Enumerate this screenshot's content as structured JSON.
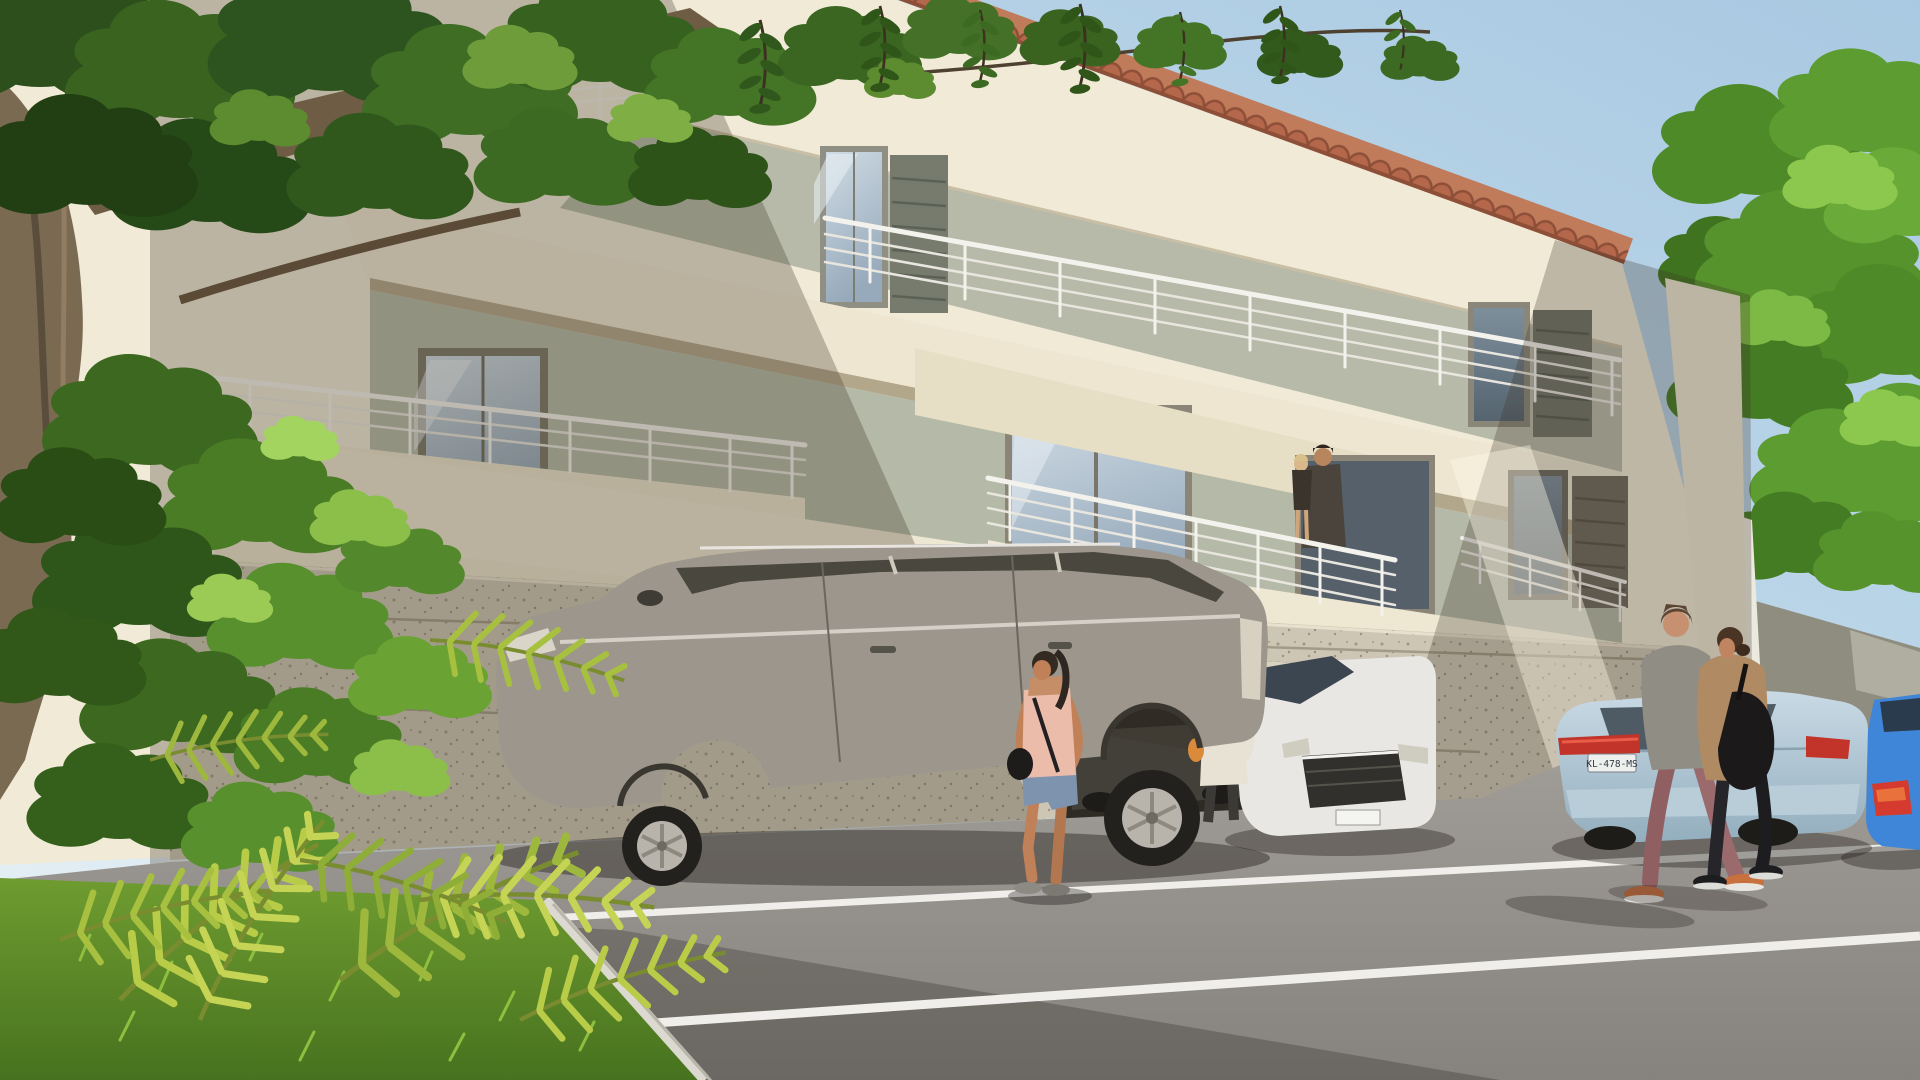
{
  "scene": {
    "type": "architectural-3d-render",
    "description": "Sunny 3D exterior rendering of a new three-storey cream apartment building with white balconies and steel railings, terracotta tile roof edge, textured stone ground floor with an open parking garage, cars parked on an asphalt lot with white bay lines, lush green tree and palm fronds in the left foreground, a second green tree at right behind a garden wall.",
    "license_plate": "KL-478-MS",
    "building": {
      "storeys": 3,
      "balcony_railing_runs": 5,
      "windows_with_shutters": 4,
      "garage_openings": 1
    },
    "vehicles": [
      "gray-station-wagon",
      "white-sedan",
      "light-blue-sedan",
      "dark-car-in-garage",
      "bright-blue-car-at-edge"
    ],
    "people": [
      "woman-pink-tank-top",
      "person-white-shirt-beanie",
      "man-holding-child-on-balcony",
      "walking-man-gray-sweater",
      "walking-woman-tan-cardigan"
    ],
    "vegetation": [
      "large-foreground-tree",
      "bush-column",
      "palm-fronds",
      "grass-strip",
      "right-side-tree"
    ]
  },
  "colors": {
    "sky_top": "#a9c9e2",
    "sky_mid": "#c2daea",
    "sky_horizon": "#e4eef4",
    "wall_cream": "#f1ead7",
    "wall_cream_shade": "#d8cdb4",
    "wall_recess": "#b7baa9",
    "slab_underside": "#b3a78b",
    "roof_tile": "#b4674a",
    "roof_tile_dark": "#8e4f38",
    "ground_wall": "#cdc6b5",
    "garage_dark": "#2e2b25",
    "asphalt": "#a5a19b",
    "asphalt_dark": "#86827e",
    "parking_line": "#efeeea",
    "grass": "#6f9c30",
    "grass_dark": "#47721f",
    "foliage_dark": "#2d4f1c",
    "foliage_mid": "#447426",
    "foliage_bright": "#8cbf4a",
    "palm_bright": "#c6d455",
    "trunk": "#7b6a52",
    "railing": "#f4f2ec",
    "window_glass": "#b6c6d2",
    "shutter_gray": "#767b6e",
    "car_gray": "#9c968c",
    "car_white": "#e8e7e3",
    "car_light_blue": "#b8cfdd",
    "car_bright_blue": "#3f86d8",
    "taillight_red": "#c2342a",
    "plate_bg": "#eef0ee",
    "plate_text_color": "#333a44",
    "skin": "#c08058",
    "tank_top_pink": "#ecbcab",
    "denim": "#7e94ae",
    "sweater_gray": "#8f8d84",
    "pants_mauve": "#9a6a6d",
    "cardigan_tan": "#b08a62",
    "garden_wall": "#8f8d7f"
  }
}
